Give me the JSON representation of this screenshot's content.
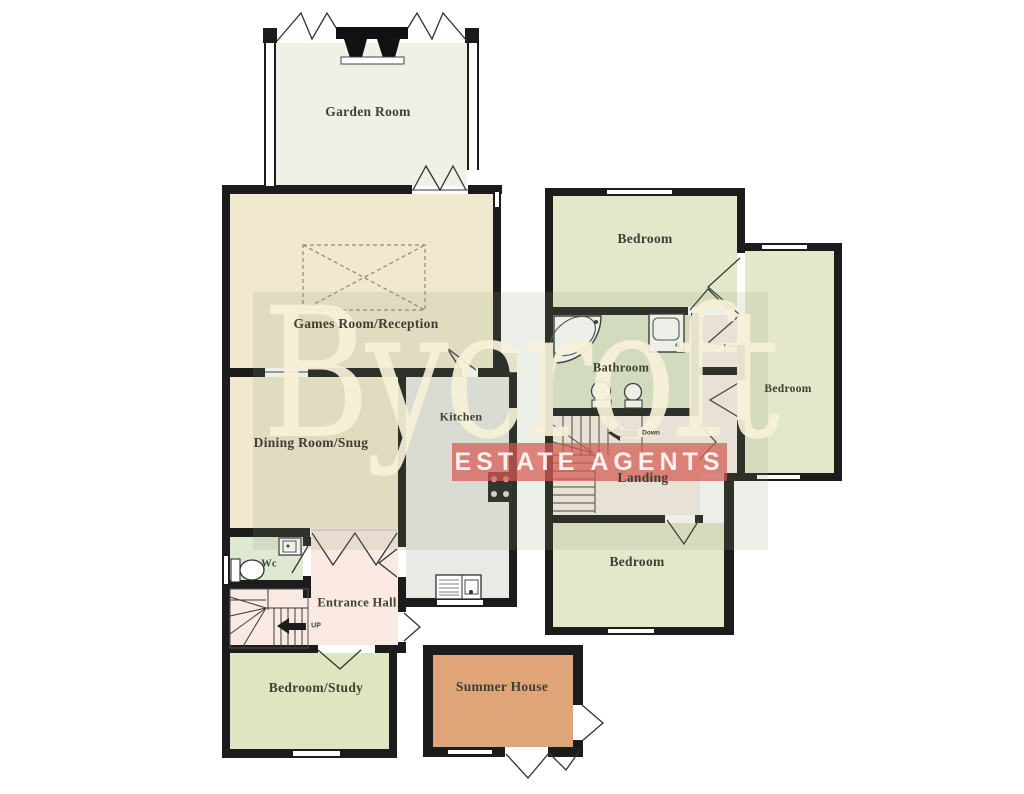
{
  "watermark": {
    "brand": "Bycroft",
    "tagline": "ESTATE AGENTS",
    "brand_color": "rgba(246,241,216,0.92)",
    "band_color": "rgba(213,90,82,0.72)",
    "tint_color": "rgba(145,155,118,0.16)"
  },
  "rooms": {
    "garden_room": {
      "label": "Garden Room"
    },
    "games_room": {
      "label": "Games Room/Reception"
    },
    "dining_room": {
      "label": "Dining Room/Snug"
    },
    "kitchen": {
      "label": "Kitchen"
    },
    "wc": {
      "label": "Wc"
    },
    "entrance_hall": {
      "label": "Entrance Hall"
    },
    "bedroom_study": {
      "label": "Bedroom/Study"
    },
    "summer_house": {
      "label": "Summer House"
    },
    "bedroom_top": {
      "label": "Bedroom"
    },
    "bedroom_right": {
      "label": "Bedroom"
    },
    "bathroom": {
      "label": "Bathroom"
    },
    "landing": {
      "label": "Landing"
    },
    "bedroom_bottom": {
      "label": "Bedroom"
    }
  },
  "stairs": {
    "ground_label": "UP",
    "first_label": "Down"
  },
  "icons": [
    "fireplace-icon",
    "billiard-table-icon",
    "bath-icon",
    "bathroom-sink-icon",
    "toilet-icon",
    "bidet-icon",
    "wc-toilet-icon",
    "wc-sink-icon",
    "hob-icon",
    "kitchen-sink-icon",
    "stairs-up-arrow-icon",
    "stairs-down-arrow-icon"
  ],
  "colors": {
    "wall": "#1c1c1c",
    "cream": "#f0e9ce",
    "garden": "#f1f0e7",
    "gray": "#e9e9e5",
    "pink": "#f9e9e2",
    "pink_light": "#f8efe9",
    "wc_green": "#dfe9d2",
    "green": "#e3e8ca",
    "green_dark": "#dee5c1",
    "bath_green": "#e0e7cc",
    "orange": "#dfa478"
  }
}
